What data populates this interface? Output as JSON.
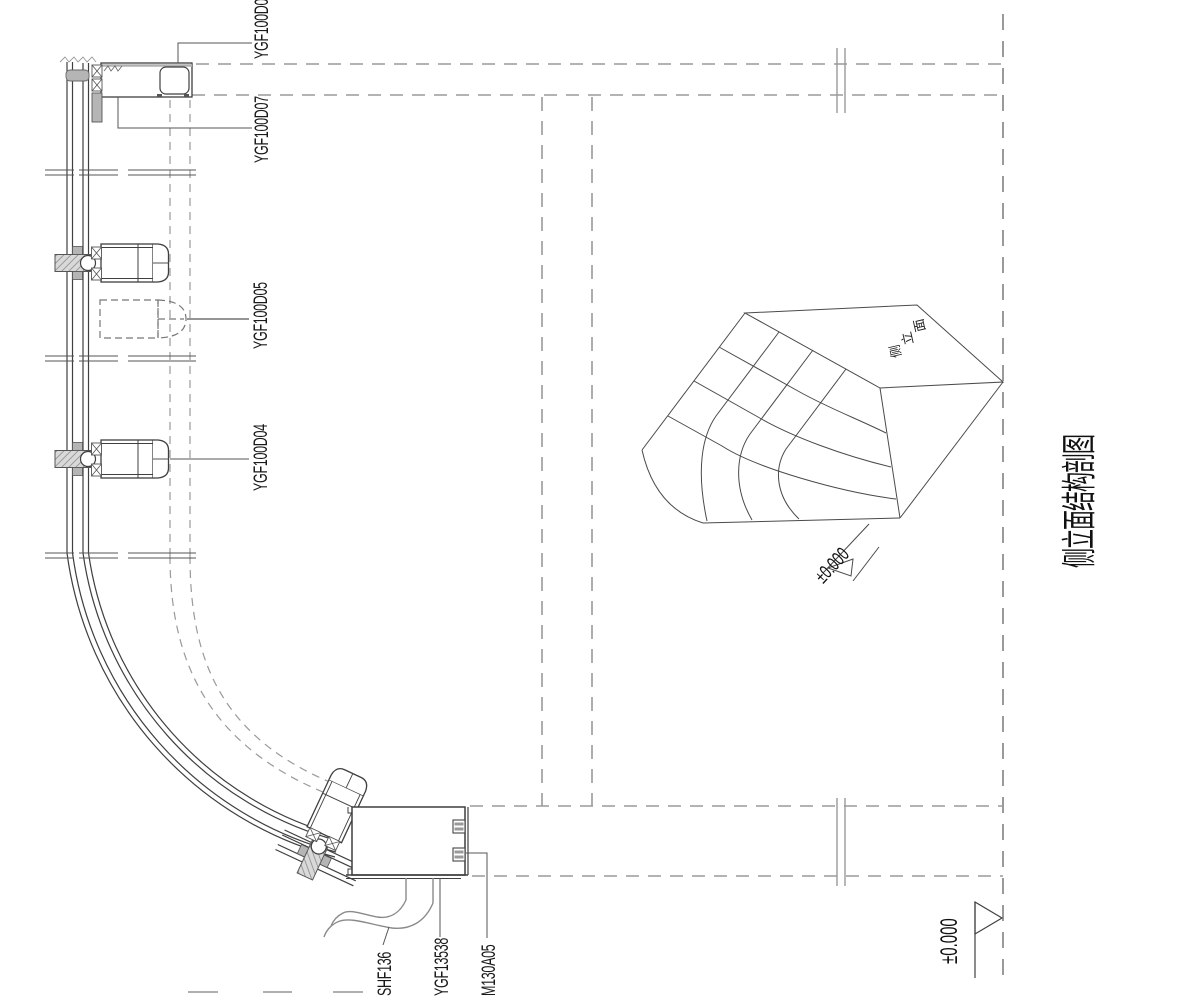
{
  "drawing_title": "侧立面结构剖图",
  "part_labels": {
    "ygf100d06": "YGF100D06",
    "ygf100d07": "YGF100D07",
    "ygf100d05": "YGF100D05",
    "ygf100d04": "YGF100D04",
    "shf136": "SHF136",
    "ygf13538": "YGF13538",
    "m130a05": "M130A05"
  },
  "key_cube": {
    "face_label": "侧立面",
    "face_label_chars": [
      "侧",
      "立",
      "面"
    ],
    "elevation_label": "±0.000"
  },
  "datum": {
    "elevation_label": "±0.000"
  },
  "colors": {
    "background": "#ffffff",
    "line": "#3f3f3f",
    "construction": "#9a9a9a",
    "cube_line": "#4a4a4a",
    "fill_gray": "#b5b5b5",
    "text": "#1a1a1a"
  }
}
